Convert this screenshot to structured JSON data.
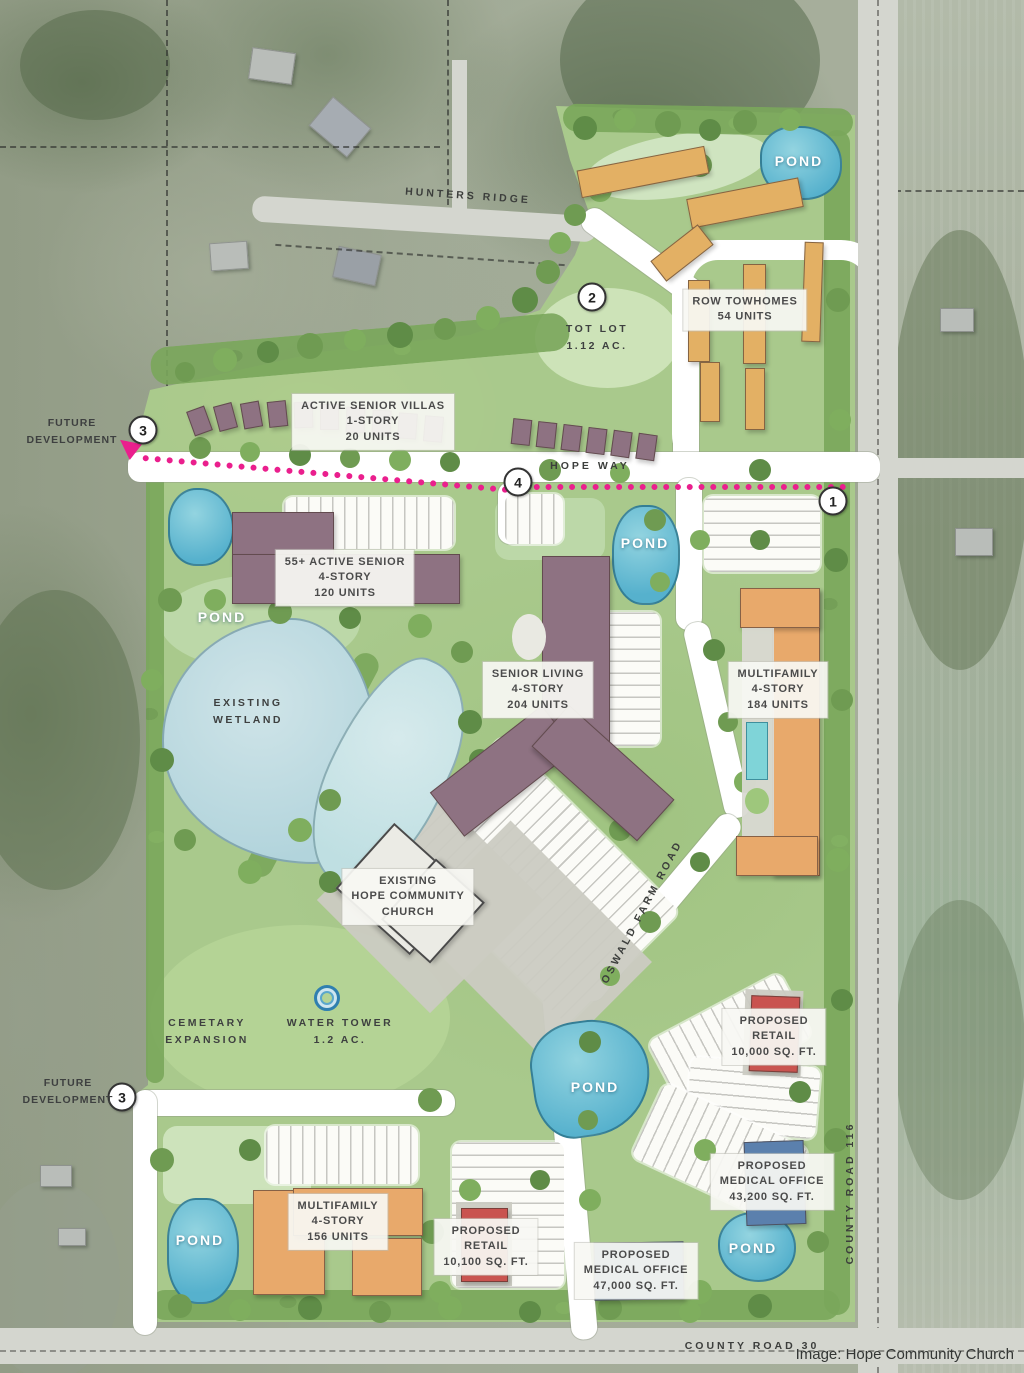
{
  "title": "Hope Community Church development site plan",
  "credit": "Image: Hope Community Church",
  "roads": {
    "hunters_ridge": "HUNTERS RIDGE",
    "hope_way": "HOPE WAY",
    "oswald_farm_road": "OSWALD FARM ROAD",
    "county_road_116": "COUNTY ROAD 116",
    "county_road_30": "COUNTY ROAD 30"
  },
  "markers": {
    "m1": "1",
    "m2": "2",
    "m3": "3",
    "m4": "4"
  },
  "water": {
    "pond": "POND",
    "wetland_l1": "EXISTING",
    "wetland_l2": "WETLAND"
  },
  "parcels": {
    "future_dev_l1": "FUTURE",
    "future_dev_l2": "DEVELOPMENT",
    "tot_lot_l1": "TOT LOT",
    "tot_lot_l2": "1.12 AC.",
    "cemetary_l1": "CEMETARY",
    "cemetary_l2": "EXPANSION",
    "water_tower_l1": "WATER TOWER",
    "water_tower_l2": "1.2 AC."
  },
  "buildings": {
    "row_townhomes": {
      "l1": "ROW TOWHOMES",
      "l2": "54 UNITS"
    },
    "active_senior_villas": {
      "l1": "ACTIVE SENIOR VILLAS",
      "l2": "1-STORY",
      "l3": "20 UNITS"
    },
    "active_senior_55": {
      "l1": "55+ ACTIVE SENIOR",
      "l2": "4-STORY",
      "l3": "120 UNITS"
    },
    "senior_living": {
      "l1": "SENIOR LIVING",
      "l2": "4-STORY",
      "l3": "204 UNITS"
    },
    "multifamily_184": {
      "l1": "MULTIFAMILY",
      "l2": "4-STORY",
      "l3": "184 UNITS"
    },
    "church": {
      "l1": "EXISTING",
      "l2": "HOPE COMMUNITY",
      "l3": "CHURCH"
    },
    "retail_10000": {
      "l1": "PROPOSED",
      "l2": "RETAIL",
      "l3": "10,000 SQ. FT."
    },
    "medical_43200": {
      "l1": "PROPOSED",
      "l2": "MEDICAL OFFICE",
      "l3": "43,200 SQ. FT."
    },
    "multifamily_156": {
      "l1": "MULTIFAMILY",
      "l2": "4-STORY",
      "l3": "156 UNITS"
    },
    "retail_10100": {
      "l1": "PROPOSED",
      "l2": "RETAIL",
      "l3": "10,100 SQ. FT."
    },
    "medical_47000": {
      "l1": "PROPOSED",
      "l2": "MEDICAL OFFICE",
      "l3": "47,000 SQ. FT."
    }
  },
  "colors": {
    "site_green": "#a9c98c",
    "pond_blue": "#56b1cd",
    "wetland_blue": "#b2d4dc",
    "senior_mauve": "#8e7282",
    "multifamily_orange": "#e8a96b",
    "townhome_tan": "#e3b064",
    "retail_red": "#c9534f",
    "medical_blue": "#5b80ad",
    "route_pink": "#ea1f8d"
  }
}
